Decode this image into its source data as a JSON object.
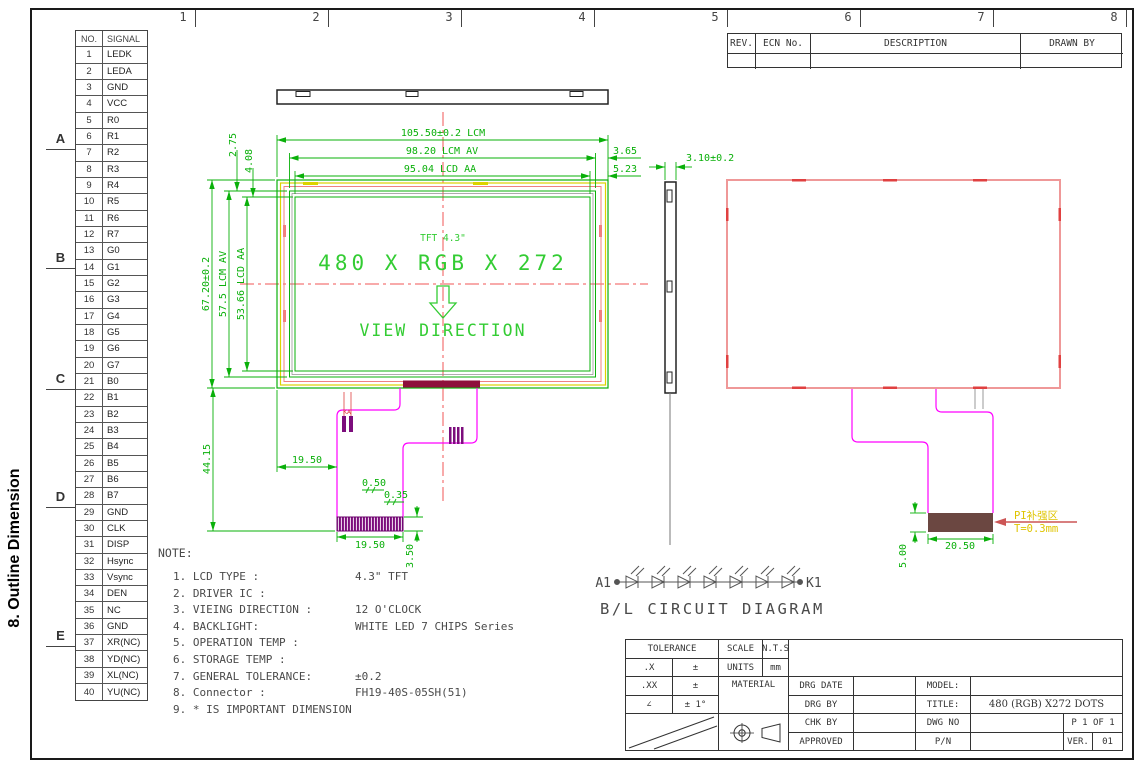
{
  "frame": {
    "columns": [
      "1",
      "2",
      "3",
      "4",
      "5",
      "6",
      "7",
      "8"
    ],
    "rows": [
      "A",
      "B",
      "C",
      "D",
      "E"
    ]
  },
  "side_heading": "8. Outline Dimension",
  "pin_table": {
    "col1": "NO.",
    "col2": "SIGNAL",
    "pins": [
      {
        "no": "1",
        "signal": "LEDK"
      },
      {
        "no": "2",
        "signal": "LEDA"
      },
      {
        "no": "3",
        "signal": "GND"
      },
      {
        "no": "4",
        "signal": "VCC"
      },
      {
        "no": "5",
        "signal": "R0"
      },
      {
        "no": "6",
        "signal": "R1"
      },
      {
        "no": "7",
        "signal": "R2"
      },
      {
        "no": "8",
        "signal": "R3"
      },
      {
        "no": "9",
        "signal": "R4"
      },
      {
        "no": "10",
        "signal": "R5"
      },
      {
        "no": "11",
        "signal": "R6"
      },
      {
        "no": "12",
        "signal": "R7"
      },
      {
        "no": "13",
        "signal": "G0"
      },
      {
        "no": "14",
        "signal": "G1"
      },
      {
        "no": "15",
        "signal": "G2"
      },
      {
        "no": "16",
        "signal": "G3"
      },
      {
        "no": "17",
        "signal": "G4"
      },
      {
        "no": "18",
        "signal": "G5"
      },
      {
        "no": "19",
        "signal": "G6"
      },
      {
        "no": "20",
        "signal": "G7"
      },
      {
        "no": "21",
        "signal": "B0"
      },
      {
        "no": "22",
        "signal": "B1"
      },
      {
        "no": "23",
        "signal": "B2"
      },
      {
        "no": "24",
        "signal": "B3"
      },
      {
        "no": "25",
        "signal": "B4"
      },
      {
        "no": "26",
        "signal": "B5"
      },
      {
        "no": "27",
        "signal": "B6"
      },
      {
        "no": "28",
        "signal": "B7"
      },
      {
        "no": "29",
        "signal": "GND"
      },
      {
        "no": "30",
        "signal": "CLK"
      },
      {
        "no": "31",
        "signal": "DISP"
      },
      {
        "no": "32",
        "signal": "Hsync"
      },
      {
        "no": "33",
        "signal": "Vsync"
      },
      {
        "no": "34",
        "signal": "DEN"
      },
      {
        "no": "35",
        "signal": "NC"
      },
      {
        "no": "36",
        "signal": "GND"
      },
      {
        "no": "37",
        "signal": "XR(NC)"
      },
      {
        "no": "38",
        "signal": "YD(NC)"
      },
      {
        "no": "39",
        "signal": "XL(NC)"
      },
      {
        "no": "40",
        "signal": "YU(NC)"
      }
    ]
  },
  "rev_table": {
    "rev": "REV.",
    "ecn": "ECN No.",
    "description": "DESCRIPTION",
    "drawn": "DRAWN BY"
  },
  "views": {
    "front": {
      "tft": "TFT 4.3\"",
      "resolution": "480 X RGB X 272",
      "view_direction": "VIEW DIRECTION",
      "pad_label": "KA"
    },
    "dims": {
      "lcm_width": "105.50±0.2 LCM",
      "av_width": "98.20 LCM AV",
      "aa_width": "95.04 LCD AA",
      "right_margin_av": "3.65",
      "right_margin_aa": "5.23",
      "thickness": "3.10±0.2",
      "lcm_height": "67.20±0.2",
      "av_height": "57.5 LCM AV",
      "aa_height": "53.66 LCD AA",
      "top_margin_av": "2.75",
      "top_margin_aa": "4.08",
      "fpc_length": "44.15",
      "fpc_offset": "19.50",
      "pitch": "0.50",
      "pad_width": "0.35",
      "connector_width": "19.50",
      "connector_height": "3.50",
      "stiffener_width": "20.50",
      "stiffener_height": "5.00"
    },
    "back": {
      "pi_label_line1": "PI补强区",
      "pi_label_line2": "T=0.3mm"
    }
  },
  "bl_circuit": {
    "start": "A1",
    "end": "K1",
    "caption": "B/L CIRCUIT DIAGRAM"
  },
  "notes": {
    "title": "NOTE:",
    "items": [
      {
        "label": "1. LCD TYPE :",
        "value": "4.3\"  TFT"
      },
      {
        "label": "2. DRIVER IC :",
        "value": ""
      },
      {
        "label": "3. VIEING DIRECTION :",
        "value": "12 O'CLOCK"
      },
      {
        "label": "4. BACKLIGHT:",
        "value": "WHITE LED 7 CHIPS Series"
      },
      {
        "label": "5. OPERATION TEMP :",
        "value": ""
      },
      {
        "label": "6. STORAGE TEMP :",
        "value": ""
      },
      {
        "label": "7. GENERAL TOLERANCE:",
        "value": "±0.2"
      },
      {
        "label": "8. Connector :",
        "value": "FH19-40S-05SH(51)"
      },
      {
        "label": "9. * IS IMPORTANT DIMENSION",
        "value": ""
      }
    ]
  },
  "title_block": {
    "tolerance": "TOLERANCE",
    "scale": "SCALE",
    "nts": "N.T.S",
    "x": ".X",
    "pm1": "±",
    "units": "UNITS",
    "mm": "mm",
    "xx": ".XX",
    "pm2": "±",
    "material": "MATERIAL",
    "drg_date": "DRG DATE",
    "model": "MODEL:",
    "angle": "∠",
    "pm_deg": "± 1°",
    "drg_by": "DRG BY",
    "title_label": "TITLE:",
    "title_value": "480 (RGB) X272 DOTS",
    "chk_by": "CHK BY",
    "dwg_no": "DWG NO",
    "page": "P 1 OF 1",
    "approved": "APPROVED",
    "pn": "P/N",
    "ver": "VER.",
    "ver_value": "01"
  },
  "colors": {
    "dim_green": "#0ab00a",
    "display_green": "#33cc33",
    "bezel_pink": "#f08080",
    "centerline_red": "#f25555",
    "accent_yellow": "#ddd300",
    "fpc_magenta": "#ff00ff",
    "connector_maroon": "#8e0f3c",
    "stiffener_brown": "#6b4741",
    "pi_text_yellow": "#dfc400"
  }
}
